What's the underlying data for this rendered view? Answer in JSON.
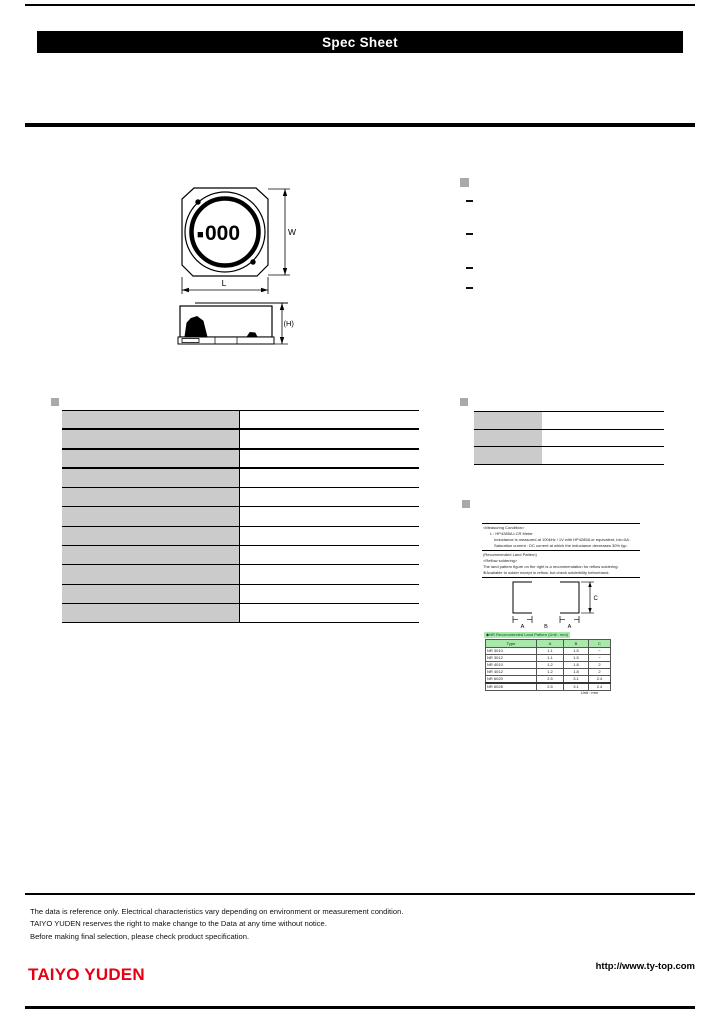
{
  "header": {
    "title": "Spec Sheet"
  },
  "drawing": {
    "marking_square": "■",
    "marking_digits": "000",
    "width_label": "W",
    "length_label": "L",
    "height_label": "(H)"
  },
  "features": {
    "items": [
      "",
      "",
      "",
      ""
    ]
  },
  "spec_table": {
    "rows": [
      {
        "label": "",
        "value": ""
      },
      {
        "label": "",
        "value": ""
      },
      {
        "label": "",
        "value": ""
      },
      {
        "label": "",
        "value": ""
      },
      {
        "label": "",
        "value": ""
      },
      {
        "label": "",
        "value": ""
      },
      {
        "label": "",
        "value": ""
      },
      {
        "label": "",
        "value": ""
      },
      {
        "label": "",
        "value": ""
      },
      {
        "label": "",
        "value": ""
      },
      {
        "label": "",
        "value": ""
      }
    ]
  },
  "info_table": {
    "rows": [
      {
        "label": "",
        "value": ""
      },
      {
        "label": "",
        "value": ""
      },
      {
        "label": "",
        "value": ""
      }
    ]
  },
  "notes": {
    "block1": [
      "<Measuring Condition>",
      "L : HP4285A LCR Meter",
      "Inductance is measured at 100kHz / 1V with HP4285A or equivalent, Idc=0A.",
      "Saturation current : DC current at which the inductance decreases 30% typ."
    ],
    "block2": [
      "(Recommended Land Pattern)",
      "<Reflow soldering>",
      "The land pattern figure on the right is a recommendation for reflow soldering.",
      "※Available to solder except in reflow, but check solderbility beforehand."
    ]
  },
  "land_pattern": {
    "dim_a": "A",
    "dim_b": "B",
    "dim_c": "C",
    "caption": "◆NR Recommended Land Pattern (Unit : mm)",
    "table": {
      "headers": [
        "Type",
        "A",
        "B",
        "C"
      ],
      "rows": [
        [
          "NR 3010",
          "1.1",
          "1.5",
          "−"
        ],
        [
          "NR 3012",
          "1.1",
          "1.5",
          "−"
        ],
        [
          "NR 4010",
          "1.2",
          "1.8",
          "2"
        ],
        [
          "NR 4012",
          "1.2",
          "1.8",
          "2"
        ],
        [
          "NR 6020",
          "2.5",
          "3.1",
          "2.4"
        ],
        [
          "NR 6028",
          "2.5",
          "3.1",
          "2.4"
        ]
      ]
    },
    "unit_note": "Unit : mm"
  },
  "footer": {
    "disclaimer": [
      "The data is reference only. Electrical characteristics vary depending on environment or measurement condition.",
      "TAIYO YUDEN reserves the right to make change to the Data at any time without notice.",
      "Before making final selection, please check product specification."
    ],
    "logo": "TAIYO YUDEN",
    "url": "http://www.ty-top.com"
  },
  "colors": {
    "logo_red": "#e60012",
    "table_green": "#a8e8a8",
    "cell_gray": "#cbcbcb"
  }
}
